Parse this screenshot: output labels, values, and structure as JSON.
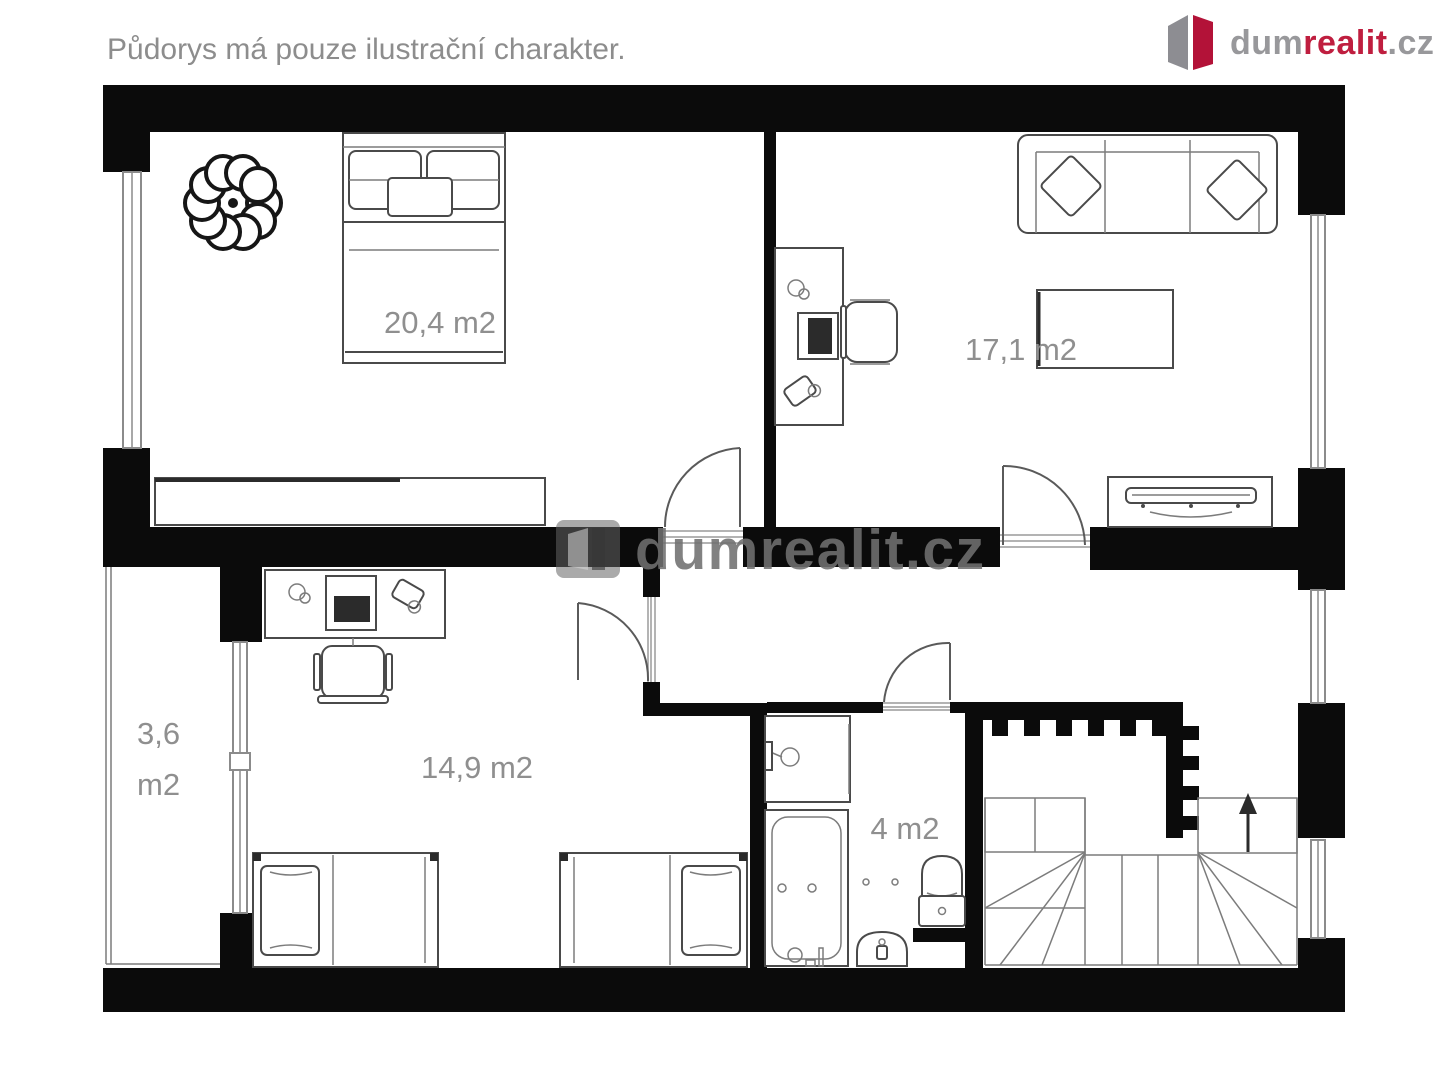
{
  "header": {
    "disclaimer": "Půdorys má pouze ilustrační charakter."
  },
  "logo": {
    "part_dum": "dum",
    "part_realit": "realit",
    "part_cz": ".cz"
  },
  "watermark": {
    "text": "dumrealit.cz"
  },
  "rooms": [
    {
      "name": "bedroom",
      "label": "20,4 m2"
    },
    {
      "name": "living-room",
      "label": "17,1 m2"
    },
    {
      "name": "children-room",
      "label": "14,9 m2"
    },
    {
      "name": "bathroom",
      "label": "4 m2"
    },
    {
      "name": "balcony",
      "label": "3,6",
      "label_unit": "m2"
    }
  ],
  "colors": {
    "wall": "#0b0b0b",
    "line": "#4a4a4a",
    "label": "#8f8f8f",
    "logo_gray": "#98989b",
    "logo_red": "#bf1e3f"
  }
}
